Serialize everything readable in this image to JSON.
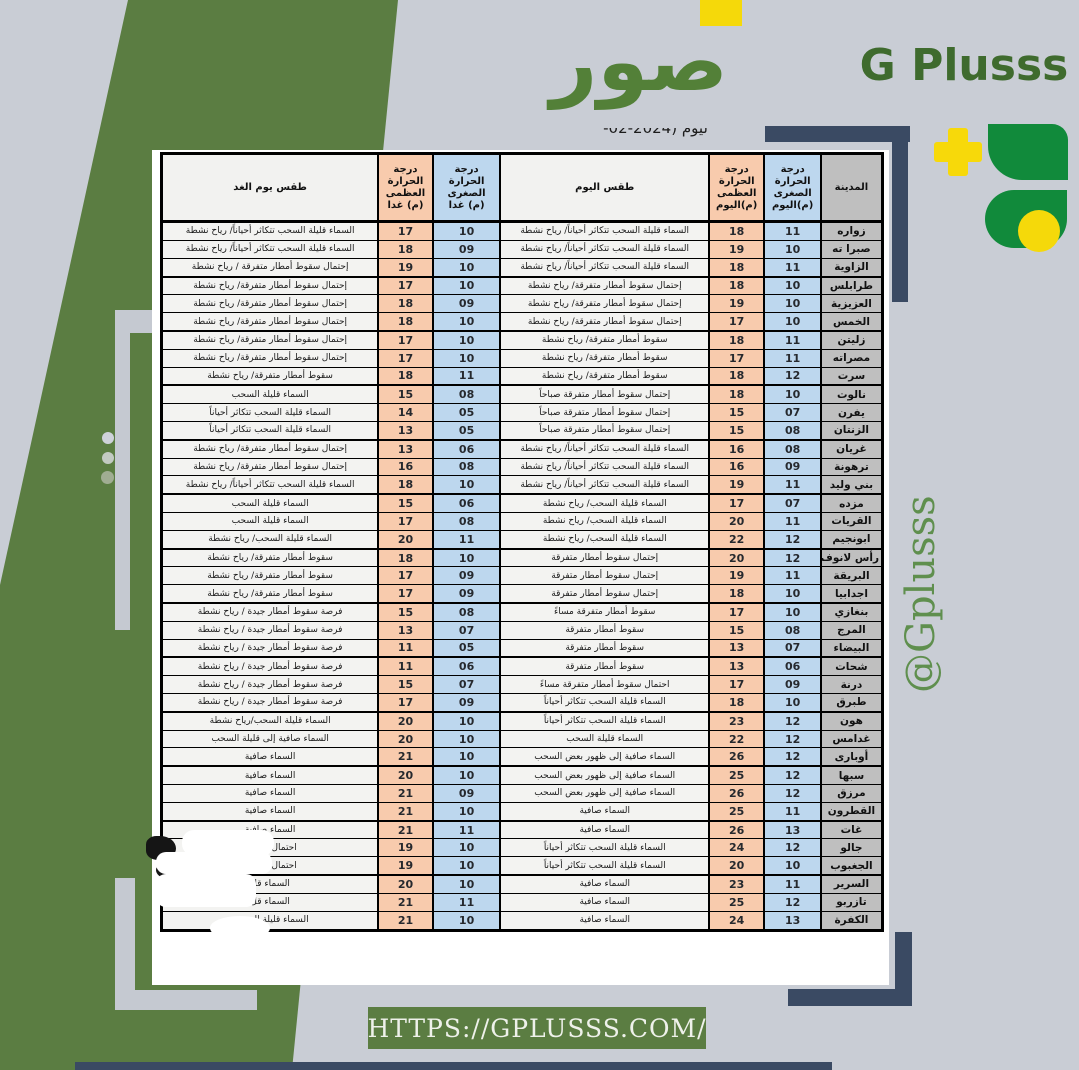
{
  "brand": {
    "site_word_ar": "صور",
    "site_name": "G Plusss",
    "handle": "@Gplusss",
    "url": "HTTPS://GPLUSSS.COM/",
    "colors": {
      "band_green": "#5b7d42",
      "logo_green": "#118a3b",
      "navy": "#3a4a63",
      "yellow": "#f5d90a",
      "text_green": "#538038"
    }
  },
  "top_fragment": "ليوم  (2024-02-",
  "table": {
    "headers": {
      "city": "المدينة",
      "today_min": "درجة\nالحرارة\nالصغرى\n(م)اليوم",
      "today_max": "درجة\nالحرارة\nالعظمى\n(م)اليوم",
      "today_wx": "طقس اليوم",
      "tmrw_min": "درجة الحرارة\nالصغرى\n(م) غدا",
      "tmrw_max": "درجة\nالحرارة\nالعظمى\n(م) غدا",
      "tmrw_wx": "طقس يوم الغد"
    },
    "cell_colors": {
      "city": "#bfbfbf",
      "min": "#bdd7ee",
      "max": "#f8cbad",
      "weather": "#f3f3f1"
    },
    "rows": [
      {
        "city": "زواره",
        "today_min": "11",
        "today_max": "18",
        "today_wx": "السماء قليلة السحب تتكاثر أحياناً/ رياح نشطة",
        "tmrw_min": "10",
        "tmrw_max": "17",
        "tmrw_wx": "السماء قليلة السحب تتكاثر أحياناً/ رياح نشطة"
      },
      {
        "city": "صبرا ته",
        "today_min": "10",
        "today_max": "19",
        "today_wx": "السماء قليلة السحب تتكاثر أحياناً/ رياح نشطة",
        "tmrw_min": "09",
        "tmrw_max": "18",
        "tmrw_wx": "السماء قليلة السحب تتكاثر أحياناً/ رياح نشطة"
      },
      {
        "city": "الزاوية",
        "today_min": "11",
        "today_max": "18",
        "today_wx": "السماء قليلة السحب تتكاثر أحياناً/ رياح نشطة",
        "tmrw_min": "10",
        "tmrw_max": "19",
        "tmrw_wx": "إحتمال سقوط أمطار متفرقة / رياح نشطة"
      },
      {
        "city": "طرابلس",
        "today_min": "10",
        "today_max": "18",
        "today_wx": "إحتمال سقوط أمطار متفرقة/ رياح نشطة",
        "tmrw_min": "10",
        "tmrw_max": "17",
        "tmrw_wx": "إحتمال سقوط أمطار متفرقة/ رياح نشطة"
      },
      {
        "city": "العزيزية",
        "today_min": "10",
        "today_max": "19",
        "today_wx": "إحتمال سقوط أمطار متفرقة/ رياح نشطة",
        "tmrw_min": "09",
        "tmrw_max": "18",
        "tmrw_wx": "إحتمال سقوط أمطار متفرقة/ رياح نشطة"
      },
      {
        "city": "الخمس",
        "today_min": "10",
        "today_max": "17",
        "today_wx": "إحتمال سقوط أمطار متفرقة/ رياح نشطة",
        "tmrw_min": "10",
        "tmrw_max": "18",
        "tmrw_wx": "إحتمال سقوط أمطار متفرقة/ رياح نشطة"
      },
      {
        "city": "زليتن",
        "today_min": "11",
        "today_max": "18",
        "today_wx": "سقوط أمطار متفرقة/ رياح نشطة",
        "tmrw_min": "10",
        "tmrw_max": "17",
        "tmrw_wx": "إحتمال سقوط أمطار متفرقة/ رياح نشطة"
      },
      {
        "city": "مصراته",
        "today_min": "11",
        "today_max": "17",
        "today_wx": "سقوط أمطار متفرقة/ رياح نشطة",
        "tmrw_min": "10",
        "tmrw_max": "17",
        "tmrw_wx": "إحتمال سقوط أمطار متفرقة/ رياح نشطة"
      },
      {
        "city": "سرت",
        "today_min": "12",
        "today_max": "18",
        "today_wx": "سقوط أمطار متفرقة/ رياح نشطة",
        "tmrw_min": "11",
        "tmrw_max": "18",
        "tmrw_wx": "سقوط أمطار متفرقة/ رياح نشطة"
      },
      {
        "city": "نالوت",
        "today_min": "10",
        "today_max": "18",
        "today_wx": "إحتمال سقوط أمطار متفرقة صباحاً",
        "tmrw_min": "08",
        "tmrw_max": "15",
        "tmrw_wx": "السماء قليلة السحب"
      },
      {
        "city": "يفرن",
        "today_min": "07",
        "today_max": "15",
        "today_wx": "إحتمال سقوط أمطار متفرقة صباحاً",
        "tmrw_min": "05",
        "tmrw_max": "14",
        "tmrw_wx": "السماء قليلة السحب تتكاثر أحياناً"
      },
      {
        "city": "الزنتان",
        "today_min": "08",
        "today_max": "15",
        "today_wx": "إحتمال سقوط أمطار متفرقة صباحاً",
        "tmrw_min": "05",
        "tmrw_max": "13",
        "tmrw_wx": "السماء قليلة السحب تتكاثر أحياناً"
      },
      {
        "city": "غريان",
        "today_min": "08",
        "today_max": "16",
        "today_wx": "السماء قليلة السحب تتكاثر أحياناً/ رياح نشطة",
        "tmrw_min": "06",
        "tmrw_max": "13",
        "tmrw_wx": "إحتمال سقوط أمطار متفرقة/ رياح نشطة"
      },
      {
        "city": "ترهونة",
        "today_min": "09",
        "today_max": "16",
        "today_wx": "السماء قليلة السحب تتكاثر أحياناً/ رياح نشطة",
        "tmrw_min": "08",
        "tmrw_max": "16",
        "tmrw_wx": "إحتمال سقوط أمطار متفرقة/ رياح نشطة"
      },
      {
        "city": "بني وليد",
        "today_min": "11",
        "today_max": "19",
        "today_wx": "السماء قليلة السحب تتكاثر أحياناً/ رياح نشطة",
        "tmrw_min": "10",
        "tmrw_max": "18",
        "tmrw_wx": "السماء قليلة السحب تتكاثر أحياناً/ رياح نشطة"
      },
      {
        "city": "مزده",
        "today_min": "07",
        "today_max": "17",
        "today_wx": "السماء قليلة السحب/ رياح نشطة",
        "tmrw_min": "06",
        "tmrw_max": "15",
        "tmrw_wx": "السماء قليلة السحب"
      },
      {
        "city": "القريات",
        "today_min": "11",
        "today_max": "20",
        "today_wx": "السماء قليلة السحب/ رياح نشطة",
        "tmrw_min": "08",
        "tmrw_max": "17",
        "tmrw_wx": "السماء قليلة السحب"
      },
      {
        "city": "ابونجيم",
        "today_min": "12",
        "today_max": "22",
        "today_wx": "السماء قليلة السحب/ رياح نشطة",
        "tmrw_min": "11",
        "tmrw_max": "20",
        "tmrw_wx": "السماء قليلة السحب/ رياح نشطة"
      },
      {
        "city": "رأس لانوف",
        "today_min": "12",
        "today_max": "20",
        "today_wx": "إحتمال سقوط أمطار متفرقة",
        "tmrw_min": "10",
        "tmrw_max": "18",
        "tmrw_wx": "سقوط أمطار متفرقة/ رياح نشطة"
      },
      {
        "city": "البريقة",
        "today_min": "11",
        "today_max": "19",
        "today_wx": "إحتمال سقوط أمطار متفرقة",
        "tmrw_min": "09",
        "tmrw_max": "17",
        "tmrw_wx": "سقوط أمطار متفرقة/ رياح نشطة"
      },
      {
        "city": "اجدابيا",
        "today_min": "10",
        "today_max": "18",
        "today_wx": "إحتمال سقوط أمطار متفرقة",
        "tmrw_min": "09",
        "tmrw_max": "17",
        "tmrw_wx": "سقوط أمطار متفرقة/ رياح نشطة"
      },
      {
        "city": "بنغازي",
        "today_min": "10",
        "today_max": "17",
        "today_wx": "سقوط أمطار متفرقة مساءً",
        "tmrw_min": "08",
        "tmrw_max": "15",
        "tmrw_wx": "فرصة سقوط أمطار جيدة / رياح نشطة"
      },
      {
        "city": "المرج",
        "today_min": "08",
        "today_max": "15",
        "today_wx": "سقوط أمطار متفرقة",
        "tmrw_min": "07",
        "tmrw_max": "13",
        "tmrw_wx": "فرصة سقوط أمطار جيدة / رياح نشطة"
      },
      {
        "city": "البيضاء",
        "today_min": "07",
        "today_max": "13",
        "today_wx": "سقوط أمطار متفرقة",
        "tmrw_min": "05",
        "tmrw_max": "11",
        "tmrw_wx": "فرصة سقوط أمطار جيدة / رياح نشطة"
      },
      {
        "city": "شحات",
        "today_min": "06",
        "today_max": "13",
        "today_wx": "سقوط أمطار متفرقة",
        "tmrw_min": "06",
        "tmrw_max": "11",
        "tmrw_wx": "فرصة سقوط أمطار جيدة / رياح نشطة"
      },
      {
        "city": "درنة",
        "today_min": "09",
        "today_max": "17",
        "today_wx": "احتمال سقوط أمطار متفرقة مساءً",
        "tmrw_min": "07",
        "tmrw_max": "15",
        "tmrw_wx": "فرصة سقوط أمطار جيدة / رياح نشطة"
      },
      {
        "city": "طبرق",
        "today_min": "10",
        "today_max": "18",
        "today_wx": "السماء قليلة السحب تتكاثر أحياناً",
        "tmrw_min": "09",
        "tmrw_max": "17",
        "tmrw_wx": "فرصة سقوط أمطار جيدة / رياح نشطة"
      },
      {
        "city": "هون",
        "today_min": "12",
        "today_max": "23",
        "today_wx": "السماء قليلة السحب تتكاثر أحياناً",
        "tmrw_min": "10",
        "tmrw_max": "20",
        "tmrw_wx": "السماء قليلة السحب/رياح نشطة"
      },
      {
        "city": "غدامس",
        "today_min": "12",
        "today_max": "22",
        "today_wx": "السماء قليلة السحب",
        "tmrw_min": "10",
        "tmrw_max": "20",
        "tmrw_wx": "السماء صافية إلى قليلة السحب"
      },
      {
        "city": "أوبارى",
        "today_min": "12",
        "today_max": "26",
        "today_wx": "السماء صافية إلى ظهور بعض السحب",
        "tmrw_min": "10",
        "tmrw_max": "21",
        "tmrw_wx": "السماء صافية"
      },
      {
        "city": "سبها",
        "today_min": "12",
        "today_max": "25",
        "today_wx": "السماء صافية إلى ظهور بعض السحب",
        "tmrw_min": "10",
        "tmrw_max": "20",
        "tmrw_wx": "السماء صافية"
      },
      {
        "city": "مرزق",
        "today_min": "12",
        "today_max": "26",
        "today_wx": "السماء صافية إلى ظهور بعض السحب",
        "tmrw_min": "09",
        "tmrw_max": "21",
        "tmrw_wx": "السماء صافية"
      },
      {
        "city": "القطرون",
        "today_min": "11",
        "today_max": "25",
        "today_wx": "السماء صافية",
        "tmrw_min": "10",
        "tmrw_max": "21",
        "tmrw_wx": "السماء صافية"
      },
      {
        "city": "غات",
        "today_min": "13",
        "today_max": "26",
        "today_wx": "السماء صافية",
        "tmrw_min": "11",
        "tmrw_max": "21",
        "tmrw_wx": "السماء صافية"
      },
      {
        "city": "جالو",
        "today_min": "12",
        "today_max": "24",
        "today_wx": "السماء قليلة السحب تتكاثر أحياناً",
        "tmrw_min": "10",
        "tmrw_max": "19",
        "tmrw_wx": "احتمال سقوط"
      },
      {
        "city": "الجغبوب",
        "today_min": "10",
        "today_max": "20",
        "today_wx": "السماء قليلة السحب تتكاثر أحياناً",
        "tmrw_min": "10",
        "tmrw_max": "19",
        "tmrw_wx": "احتمال سقوط"
      },
      {
        "city": "السرير",
        "today_min": "11",
        "today_max": "23",
        "today_wx": "السماء صافية",
        "tmrw_min": "10",
        "tmrw_max": "20",
        "tmrw_wx": "السماء قل"
      },
      {
        "city": "تازربو",
        "today_min": "12",
        "today_max": "25",
        "today_wx": "السماء صافية",
        "tmrw_min": "11",
        "tmrw_max": "21",
        "tmrw_wx": "السماء قل"
      },
      {
        "city": "الكفرة",
        "today_min": "13",
        "today_max": "24",
        "today_wx": "السماء صافية",
        "tmrw_min": "10",
        "tmrw_max": "21",
        "tmrw_wx": "السماء قليلة السحب"
      }
    ]
  }
}
